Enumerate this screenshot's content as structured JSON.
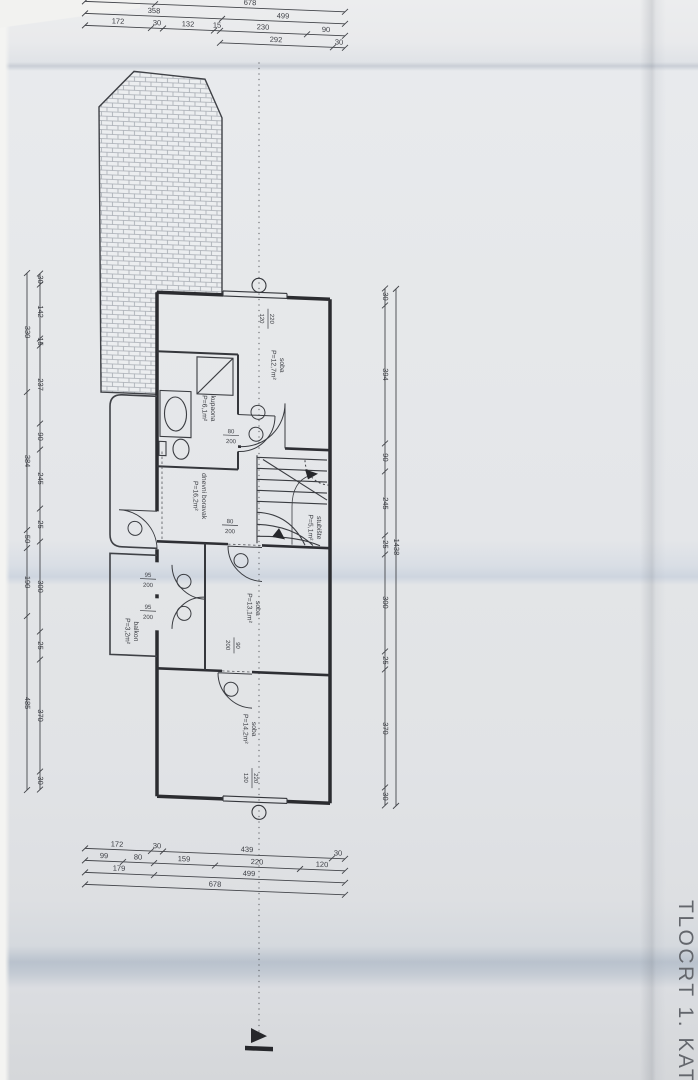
{
  "title": "TLOCRT 1. KATA",
  "colors": {
    "ink": "#35373c",
    "paper": "#e6e8ea"
  },
  "rooms": [
    {
      "name": "soba",
      "area": "P=12,7m²"
    },
    {
      "name": "kupaona",
      "area": "P=6,1m²"
    },
    {
      "name": "dnevni boravak",
      "area": "P=16,2m²"
    },
    {
      "name": "stubište",
      "area": "P=5,1m²"
    },
    {
      "name": "balkon",
      "area": "P=3,2m²"
    },
    {
      "name": "soba",
      "area": "P=13,1m²"
    },
    {
      "name": "soba",
      "area": "P=14,2m²"
    }
  ],
  "openings": [
    {
      "num": "80",
      "den": "200"
    },
    {
      "num": "80",
      "den": "200"
    },
    {
      "num": "95",
      "den": "200"
    },
    {
      "num": "95",
      "den": "200"
    },
    {
      "num": "90",
      "den": "200"
    },
    {
      "num": "220",
      "den": "120"
    },
    {
      "num": "220",
      "den": "120"
    }
  ],
  "dimensions": {
    "top": [
      [
        "179",
        "678"
      ],
      [
        "358",
        "499"
      ],
      [
        "172",
        "30",
        "132",
        "15",
        "230",
        "90"
      ],
      [
        "292",
        "30"
      ]
    ],
    "bottom": [
      [
        "172",
        "30",
        "439",
        "30"
      ],
      [
        "99",
        "80",
        "159",
        "220",
        "120"
      ],
      [
        "179",
        "499"
      ],
      [
        "678"
      ]
    ],
    "left_outer": [
      "330",
      "384",
      "50",
      "190",
      "485"
    ],
    "left_inner": [
      "30",
      "142",
      "15",
      "237",
      "90",
      "245",
      "25",
      "300",
      "25",
      "370",
      "30"
    ],
    "right_inner": [
      "30",
      "394",
      "90",
      "245",
      "25",
      "300",
      "25",
      "370",
      "30"
    ],
    "right_outer": [
      "1438"
    ]
  }
}
